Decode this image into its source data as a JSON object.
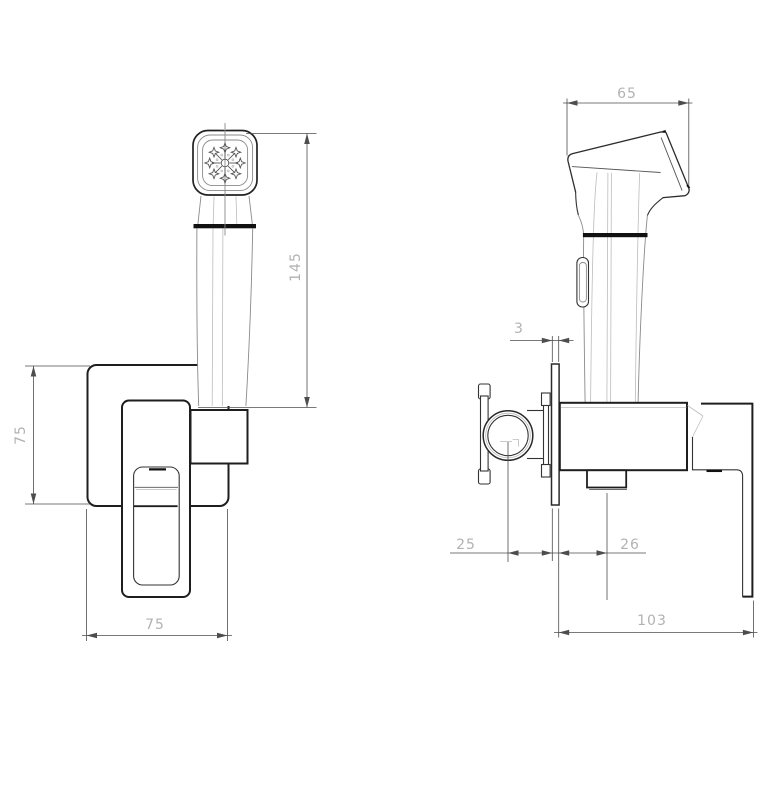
{
  "drawing": {
    "views": {
      "front": {
        "dims": {
          "height": "145",
          "plate_height": "75",
          "plate_width": "75"
        }
      },
      "side": {
        "dims": {
          "head_width": "65",
          "plate_thickness": "3",
          "inlet_to_wall": "25",
          "wall_to_outlet": "26",
          "depth": "103"
        }
      }
    },
    "colors": {
      "object_line": "#1e1e1e",
      "thin_line": "#8a8a8a",
      "dim_line": "#4d4d4d",
      "dim_text": "#b2b2b2",
      "background": "#ffffff",
      "accent_black": "#111111"
    }
  }
}
